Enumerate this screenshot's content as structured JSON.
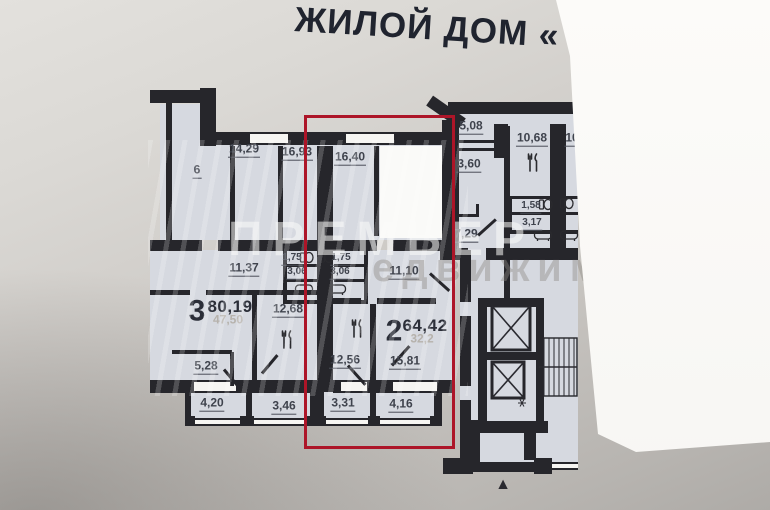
{
  "title": "ЖИЛОЙ ДОМ «",
  "watermark": {
    "line1": "ПРЕМЬЕР",
    "line2": "едвижимо"
  },
  "colors": {
    "highlight": "#ad1528",
    "wall": "#26262b",
    "room_fill": "#d6d9e0",
    "paper": "#cfccc8"
  },
  "highlight_box": {
    "x": 304,
    "y": 115,
    "w": 151,
    "h": 334
  },
  "north_arrow": "▲",
  "apartments": [
    {
      "id": "apt-2-highlighted",
      "rooms_count": "2",
      "total_area": "64,42",
      "living_area": "32,2",
      "highlighted": true,
      "room_areas": [
        "16,40",
        "1,75",
        "3,06",
        "11,10",
        "12,56",
        "15,81",
        "3,31",
        "4,16"
      ]
    },
    {
      "id": "apt-3-left",
      "rooms_count": "3",
      "total_area": "80,19",
      "living_area": "47,50",
      "highlighted": false,
      "room_areas": [
        "14,29",
        "16,93",
        "11,37",
        "1,75",
        "3,06",
        "12,68",
        "5,28",
        "4,20",
        "3,46"
      ]
    }
  ],
  "plan": {
    "labels": [
      {
        "id": "area-6",
        "text": "6",
        "x": 197,
        "y": 171,
        "cls": "room"
      },
      {
        "id": "area-14-29",
        "text": "14,29",
        "x": 244,
        "y": 150,
        "cls": "room"
      },
      {
        "id": "area-16-93",
        "text": "16,93",
        "x": 297,
        "y": 153,
        "cls": "room"
      },
      {
        "id": "area-16-40",
        "text": "16,40",
        "x": 350,
        "y": 158,
        "cls": "room"
      },
      {
        "id": "area-5-08",
        "text": "5,08",
        "x": 471,
        "y": 127,
        "cls": "room"
      },
      {
        "id": "area-10-68",
        "text": "10,68",
        "x": 532,
        "y": 139,
        "cls": "room"
      },
      {
        "id": "area-10",
        "text": "10",
        "x": 572,
        "y": 139,
        "cls": "room"
      },
      {
        "id": "area-3-60",
        "text": "3,60",
        "x": 469,
        "y": 165,
        "cls": "room"
      },
      {
        "id": "area-7-29",
        "text": "7,29",
        "x": 466,
        "y": 235,
        "cls": "room"
      },
      {
        "id": "area-11-37",
        "text": "11,37",
        "x": 244,
        "y": 269,
        "cls": "room"
      },
      {
        "id": "area-11-10",
        "text": "11,10",
        "x": 404,
        "y": 272,
        "cls": "room"
      },
      {
        "id": "area-12-68",
        "text": "12,68",
        "x": 288,
        "y": 310,
        "cls": "room"
      },
      {
        "id": "area-12-56",
        "text": "12,56",
        "x": 345,
        "y": 361,
        "cls": "room"
      },
      {
        "id": "area-15-81",
        "text": "15,81",
        "x": 405,
        "y": 362,
        "cls": "room"
      },
      {
        "id": "area-5-28",
        "text": "5,28",
        "x": 206,
        "y": 367,
        "cls": "room"
      },
      {
        "id": "area-4-20",
        "text": "4,20",
        "x": 212,
        "y": 404,
        "cls": "room"
      },
      {
        "id": "area-3-46",
        "text": "3,46",
        "x": 284,
        "y": 407,
        "cls": "room"
      },
      {
        "id": "area-3-31",
        "text": "3,31",
        "x": 343,
        "y": 404,
        "cls": "room"
      },
      {
        "id": "area-4-16",
        "text": "4,16",
        "x": 401,
        "y": 405,
        "cls": "room"
      },
      {
        "id": "area-1-75-left",
        "text": "1,75",
        "x": 292,
        "y": 259,
        "cls": "small"
      },
      {
        "id": "area-3-06-left",
        "text": "3,06",
        "x": 297,
        "y": 273,
        "cls": "small"
      },
      {
        "id": "area-1-75-right",
        "text": "1,75",
        "x": 341,
        "y": 259,
        "cls": "small"
      },
      {
        "id": "area-3-06-right",
        "text": "3,06",
        "x": 340,
        "y": 273,
        "cls": "small"
      },
      {
        "id": "area-1-58",
        "text": "1,58",
        "x": 531,
        "y": 207,
        "cls": "small"
      },
      {
        "id": "area-3-17",
        "text": "3,17",
        "x": 532,
        "y": 224,
        "cls": "small"
      },
      {
        "id": "apt3-rooms-count",
        "text": "3",
        "x": 197,
        "y": 311,
        "cls": "apt-big"
      },
      {
        "id": "apt3-total-area",
        "text": "80,19",
        "x": 230,
        "y": 307,
        "cls": "apt-total"
      },
      {
        "id": "apt3-living-area",
        "text": "47,50",
        "x": 228,
        "y": 320,
        "cls": "apt-sub"
      },
      {
        "id": "apt2-rooms-count",
        "text": "2",
        "x": 394,
        "y": 331,
        "cls": "apt-big"
      },
      {
        "id": "apt2-total-area",
        "text": "64,42",
        "x": 425,
        "y": 326,
        "cls": "apt-total"
      },
      {
        "id": "apt2-living-area",
        "text": "32,2",
        "x": 422,
        "y": 339,
        "cls": "apt-sub"
      }
    ]
  }
}
